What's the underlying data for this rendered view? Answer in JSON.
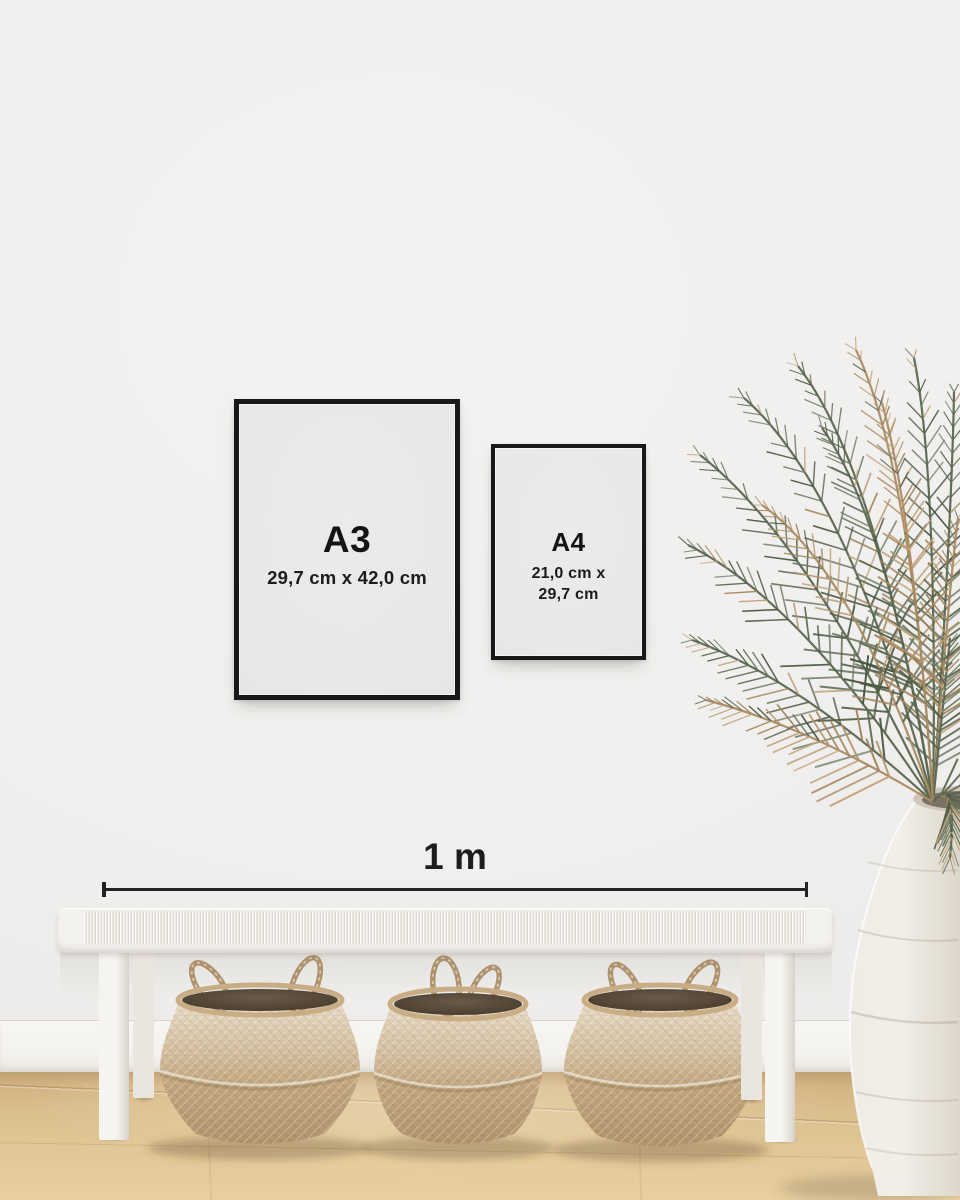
{
  "frames": [
    {
      "label": "A3",
      "dimensions": [
        "29,7 cm x 42,0 cm"
      ]
    },
    {
      "label": "A4",
      "dimensions": [
        "21,0 cm x",
        "29,7 cm"
      ]
    }
  ],
  "scale_bar": {
    "label": "1 m"
  },
  "colors": {
    "wall": "#f0efed",
    "baseboard": "#f5f3ef",
    "floor_wood": "#ddc190",
    "frame_black": "#181818",
    "poster_paper": "#e9e8e6",
    "text": "#1a1a1a",
    "bench_white": "#f4f2ef",
    "basket_tan": "#c3a87f",
    "basket_interior": "#5e5140",
    "vase_white": "#ece8e1",
    "leaf_green": "#5d6952",
    "leaf_tan": "#b3946c"
  }
}
